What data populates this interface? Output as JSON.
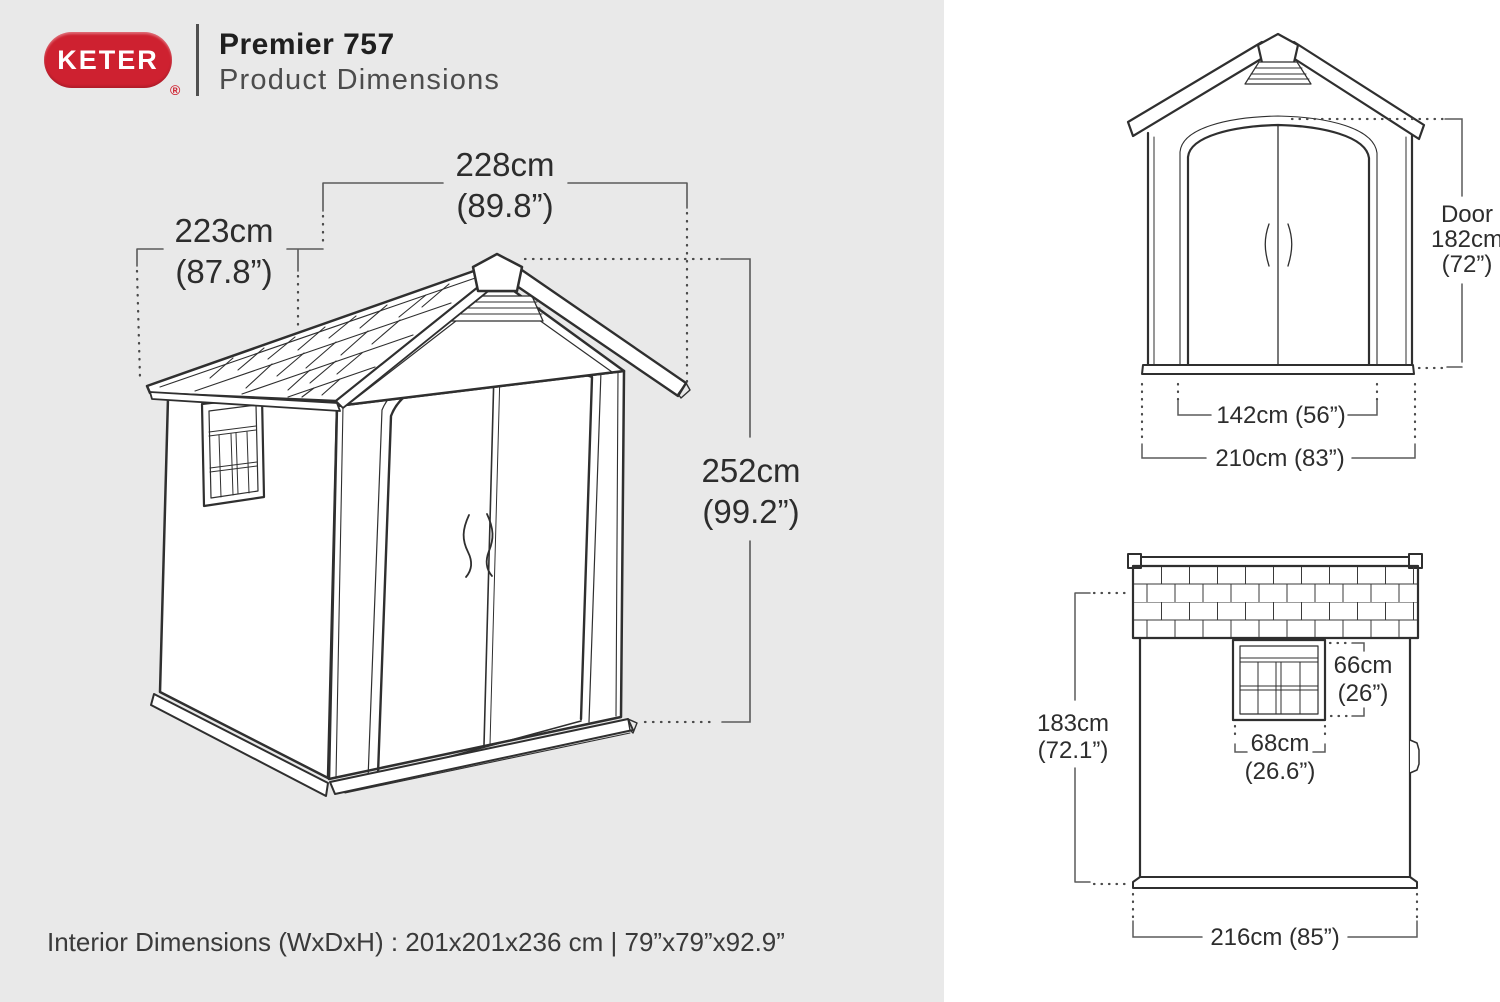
{
  "colors": {
    "brand_red": "#ce2130",
    "left_panel_bg": "#e9e9e9",
    "right_panel_bg": "#ffffff",
    "line_art": "#2f2f2f"
  },
  "header": {
    "brand": "KETER",
    "registered": "®",
    "product_name": "Premier 757",
    "subtitle": "Product Dimensions"
  },
  "iso_view": {
    "depth": {
      "cm": "228cm",
      "inch": "(89.8”)"
    },
    "width": {
      "cm": "223cm",
      "inch": "(87.8”)"
    },
    "height": {
      "cm": "252cm",
      "inch": "(99.2”)"
    }
  },
  "front_view": {
    "door": {
      "label": "Door",
      "cm": "182cm",
      "inch": "(72”)"
    },
    "door_width": "142cm (56”)",
    "overall_width": "210cm (83”)"
  },
  "side_view": {
    "wall_height": {
      "cm": "183cm",
      "inch": "(72.1”)"
    },
    "window_height": {
      "cm": "66cm",
      "inch": "(26”)"
    },
    "window_width": {
      "cm": "68cm",
      "inch": "(26.6”)"
    },
    "overall_depth": "216cm (85”)"
  },
  "footer": {
    "interior_dimensions": "Interior Dimensions (WxDxH) : 201x201x236 cm | 79”x79”x92.9”"
  }
}
